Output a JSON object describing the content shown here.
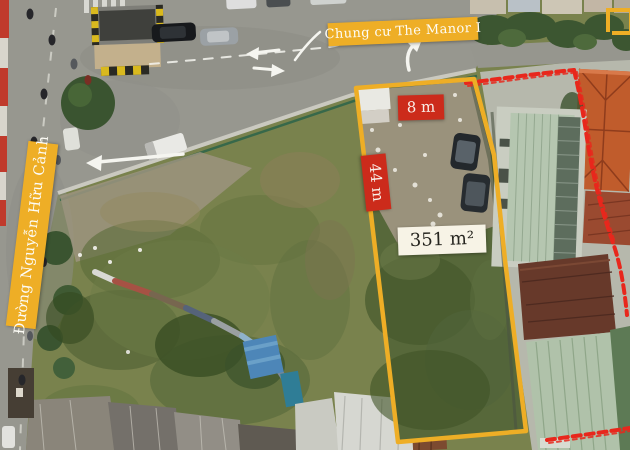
{
  "photo": {
    "type": "aerial-drone-photo-of-land-plot",
    "annotations": {
      "complex_label": "Chung cư The Manor I",
      "street_label": "Đường Nguyễn Hữu Cảnh",
      "plot_width_label": "8 m",
      "plot_depth_label": "44 m",
      "plot_area_label": "351 m²"
    },
    "colors": {
      "annotation_yellow": "#eeae26",
      "dimension_red": "#cc2b1b",
      "boundary_red": "#e8271c",
      "area_box_bg": "#f7f3e6"
    }
  }
}
